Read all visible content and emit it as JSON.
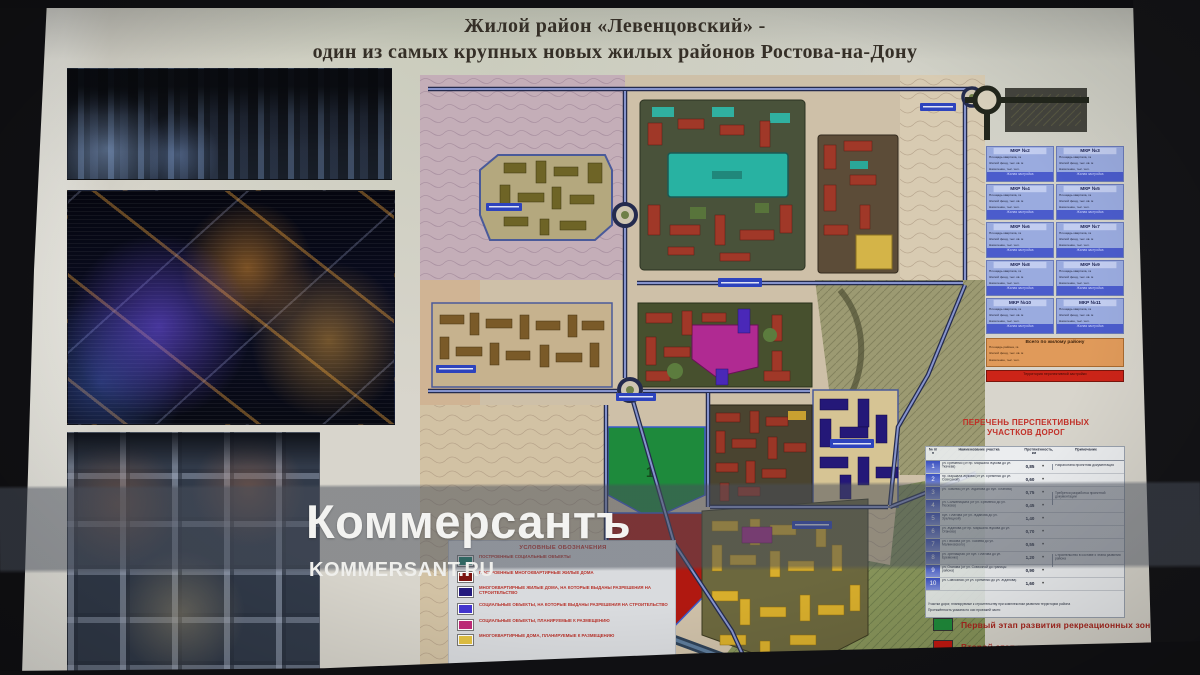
{
  "watermark": {
    "wordmark": "Коммерсантъ",
    "site": "KOMMERSANT.RU"
  },
  "title": {
    "line1": "Жилой район «Левенцовский» -",
    "line2": "один из самых крупных новых жилых районов Ростова-на-Дону"
  },
  "map": {
    "zone1_label": "1",
    "zone2_label": "2"
  },
  "legend": {
    "title": "УСЛОВНЫЕ ОБОЗНАЧЕНИЯ",
    "items": [
      {
        "color": "#15806a",
        "label": "ПОСТРОЕННЫЕ СОЦИАЛЬНЫЕ ОБЪЕКТЫ"
      },
      {
        "color": "#7c1410",
        "label": "ПОСТРОЕННЫЕ МНОГОКВАРТИРНЫЕ ЖИЛЫЕ ДОМА"
      },
      {
        "color": "#251b7e",
        "label": "МНОГОКВАРТИРНЫЕ ЖИЛЫЕ ДОМА, НА КОТОРЫЕ ВЫДАНЫ РАЗРЕШЕНИЯ НА СТРОИТЕЛЬСТВО"
      },
      {
        "color": "#4334cf",
        "label": "СОЦИАЛЬНЫЕ ОБЪЕКТЫ, НА КОТОРЫЕ ВЫДАНЫ РАЗРЕШЕНИЯ НА СТРОИТЕЛЬСТВО"
      },
      {
        "color": "#bf2a78",
        "label": "СОЦИАЛЬНЫЕ ОБЪЕКТЫ, ПЛАНИРУЕМЫЕ К РАЗМЕЩЕНИЮ"
      },
      {
        "color": "#e3c243",
        "label": "МНОГОКВАРТИРНЫЕ ДОМА, ПЛАНИРУЕМЫЕ К РАЗМЕЩЕНИЮ"
      }
    ]
  },
  "mkr_panel": {
    "cards": [
      {
        "title": "МКР №2",
        "lines": [
          "Площадь квартала, га",
          "Жилой фонд, тыс. кв. м",
          "Население, тыс. чел."
        ],
        "footer": "Жилая застройка"
      },
      {
        "title": "МКР №3",
        "lines": [
          "Площадь квартала, га",
          "Жилой фонд, тыс. кв. м",
          "Население, тыс. чел."
        ],
        "footer": "Жилая застройка"
      },
      {
        "title": "МКР №4",
        "lines": [
          "Площадь квартала, га",
          "Жилой фонд, тыс. кв. м",
          "Население, тыс. чел."
        ],
        "footer": "Жилая застройка"
      },
      {
        "title": "МКР №5",
        "lines": [
          "Площадь квартала, га",
          "Жилой фонд, тыс. кв. м",
          "Население, тыс. чел."
        ],
        "footer": "Жилая застройка"
      },
      {
        "title": "МКР №6",
        "lines": [
          "Площадь квартала, га",
          "Жилой фонд, тыс. кв. м",
          "Население, тыс. чел."
        ],
        "footer": "Жилая застройка"
      },
      {
        "title": "МКР №7",
        "lines": [
          "Площадь квартала, га",
          "Жилой фонд, тыс. кв. м",
          "Население, тыс. чел."
        ],
        "footer": "Жилая застройка"
      },
      {
        "title": "МКР №8",
        "lines": [
          "Площадь квартала, га",
          "Жилой фонд, тыс. кв. м",
          "Население, тыс. чел."
        ],
        "footer": "Жилая застройка"
      },
      {
        "title": "МКР №9",
        "lines": [
          "Площадь квартала, га",
          "Жилой фонд, тыс. кв. м",
          "Население, тыс. чел."
        ],
        "footer": "Жилая застройка"
      },
      {
        "title": "МКР №10",
        "lines": [
          "Площадь квартала, га",
          "Жилой фонд, тыс. кв. м",
          "Население, тыс. чел."
        ],
        "footer": "Жилая застройка"
      },
      {
        "title": "МКР №11",
        "lines": [
          "Площадь квартала, га",
          "Жилой фонд, тыс. кв. м",
          "Население, тыс. чел."
        ],
        "footer": "Жилая застройка"
      }
    ],
    "summary": {
      "title": "Всего по жилому району",
      "lines": [
        "Площадь района, га",
        "Жилой фонд, тыс. кв. м",
        "Население, тыс. чел."
      ],
      "banner": "Территория перспективной застройки"
    }
  },
  "roads_table": {
    "title_line1": "ПЕРЕЧЕНЬ ПЕРСПЕКТИВНЫХ",
    "title_line2": "УЧАСТКОВ ДОРОГ",
    "columns": [
      "№ п/п",
      "Наименование участка",
      "Протяжённость, км",
      "Примечание"
    ],
    "rows": [
      {
        "num": "1",
        "name": "ул. Еременко (от пр. Маршала Жукова до ул. Ткачева)",
        "len": "0,85"
      },
      {
        "num": "2",
        "name": "пр. Маршала Жукова (от ул. Еременко до ул. Совхозной)",
        "len": "0,60"
      },
      {
        "num": "3",
        "name": "ул. Ткачева (от ул. Жданова до бул. Платова)",
        "len": "0,75"
      },
      {
        "num": "4",
        "name": "ул. Солженицына (от ул. Еременко до ул. Пескова)",
        "len": "0,45"
      },
      {
        "num": "5",
        "name": "бул. Платова (от ул. Жданова до ул. Зрелищной)",
        "len": "1,40"
      },
      {
        "num": "6",
        "name": "ул. Жданова (от пр. Маршала Жукова до ул. Оганова)",
        "len": "0,70"
      },
      {
        "num": "7",
        "name": "ул. Пескова (от ул. Ткачева до ул. Малиновского)",
        "len": "0,55"
      },
      {
        "num": "8",
        "name": "ул. Зрелищная (от бул. Платова до ул. Еременко)",
        "len": "1,20"
      },
      {
        "num": "9",
        "name": "ул. Оганова (от ул. Совхозной до границы района)",
        "len": "0,90"
      },
      {
        "num": "10",
        "name": "ул. Совхозная (от ул. Еременко до ул. Жданова)",
        "len": "1,60"
      }
    ],
    "notes": [
      "Разработана проектная документация",
      "Требуется разработка проектной документации",
      "Строительство в составе II этапа развития района"
    ],
    "footnotes": [
      "Участки дорог, планируемые к строительству при комплексном развитии территории района",
      "Протяжённость указана по оси проезжей части"
    ]
  },
  "stage_legend": [
    {
      "color": "#1f8a3a",
      "label": "Первый этап развития рекреационных зон"
    },
    {
      "color": "#c01810",
      "label": "Второй этап развития рекреационных зон"
    }
  ]
}
